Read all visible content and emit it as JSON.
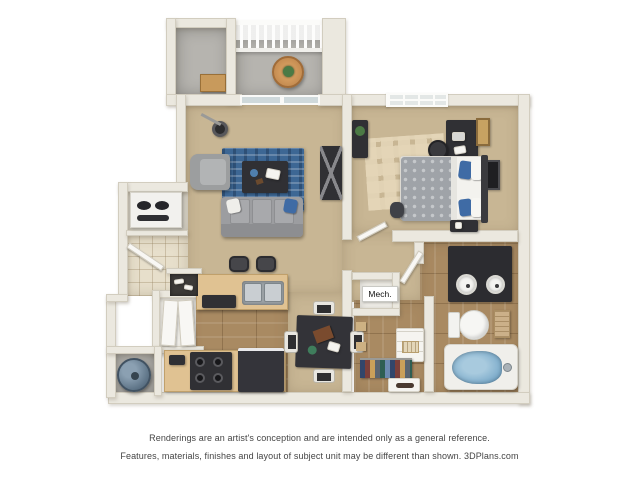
{
  "labels": {
    "mech": "Mech."
  },
  "disclaimer": {
    "line1": "Renderings are an artist's conception and are intended only as a general reference.",
    "line2": "Features, materials, finishes and layout of subject unit may be different than shown. 3DPlans.com"
  },
  "colors": {
    "wall": "#ebe8df",
    "wall_edge": "#d2cdbf",
    "carpet": "#c8b694",
    "wood": "#a98a62",
    "tile": "#e7dfcb",
    "concrete": "#b6b4af",
    "rug": "#3d6794",
    "sofa": "#9c9da0",
    "furn_dark": "#303034",
    "counter": "#e0c292",
    "steel": "#c9ced2",
    "tub": "#79a9c9",
    "heater": "#5e7487",
    "plant": "#4c7a45",
    "pillow_blue": "#3f6ba5",
    "text": "#454545"
  }
}
